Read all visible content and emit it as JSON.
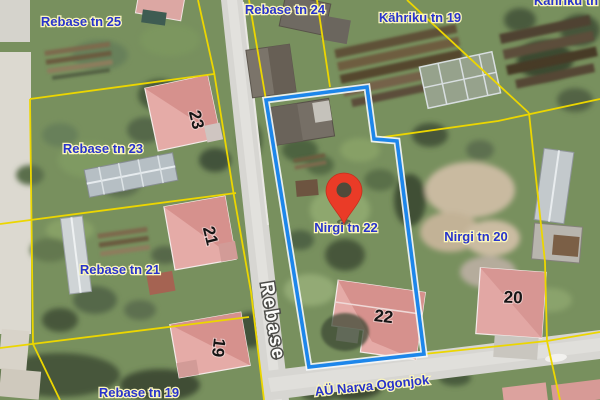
{
  "map": {
    "kind": "satellite-cadastral-view",
    "labels": {
      "rebase25": "Rebase tn 25",
      "rebase24": "Rebase tn 24",
      "kahriku19": "Kähriku tn 19",
      "kahrikuPartial": "Kähriku tn",
      "rebase23": "Rebase tn 23",
      "rebase21": "Rebase tn 21",
      "rebase19": "Rebase tn 19",
      "nirgi22": "Nirgi tn 22",
      "nirgi20": "Nirgi tn 20",
      "streetRebase": "Rebase",
      "streetNarva": "AÜ Narva Ogonjok"
    },
    "building_numbers": {
      "b23": "23",
      "b21": "21",
      "b19": "19",
      "b22": "22",
      "b20": "20"
    },
    "marker": {
      "location": "Nirgi tn 22"
    },
    "colors": {
      "pin_red": "#ea3b27",
      "selected_boundary_blue": "#1d86ea",
      "cadastral_yellow": "#ecd600",
      "label_blue": "#2833cc"
    }
  }
}
